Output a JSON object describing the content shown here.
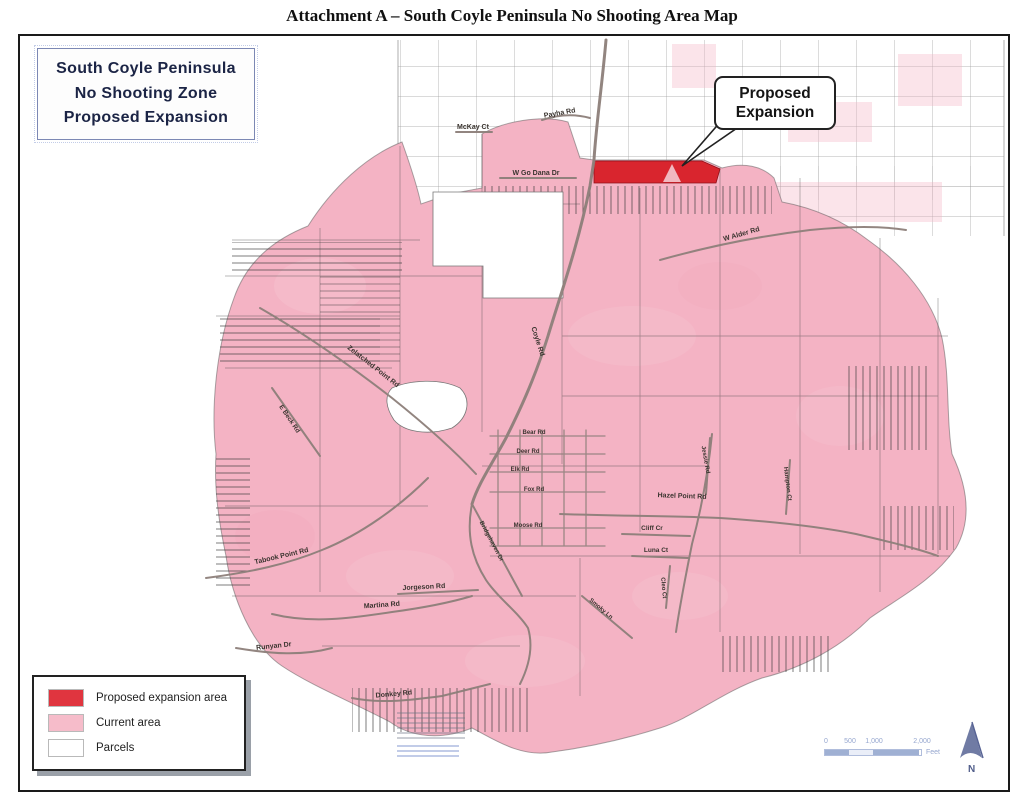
{
  "page": {
    "title": "Attachment A – South Coyle Peninsula No Shooting Area Map"
  },
  "map": {
    "inset_title": {
      "lines": [
        "South Coyle Peninsula",
        "No Shooting Zone",
        "Proposed Expansion"
      ]
    },
    "callout": {
      "lines": [
        "Proposed",
        "Expansion"
      ]
    },
    "legend": {
      "items": [
        {
          "label": "Proposed expansion area",
          "color": "#e0353f"
        },
        {
          "label": "Current area",
          "color": "#f6bcca"
        },
        {
          "label": "Parcels",
          "color": "#ffffff"
        }
      ]
    },
    "scale_bar": {
      "ticks": [
        "0",
        "500",
        "1,000",
        "2,000"
      ],
      "unit": "Feet"
    },
    "north_label": "N",
    "colors": {
      "current_area": "#f4b3c4",
      "expansion_area": "#d9252e",
      "parcel_line": "#444444",
      "road": "#8d7f7a"
    },
    "road_labels": [
      {
        "text": "McKay Ct",
        "x": 453,
        "y": 93,
        "rot": 0,
        "s": 7
      },
      {
        "text": "Payha Rd",
        "x": 540,
        "y": 79,
        "rot": -10,
        "s": 7
      },
      {
        "text": "W Go Dana Dr",
        "x": 516,
        "y": 139,
        "rot": 0,
        "s": 7
      },
      {
        "text": "W Alder Rd",
        "x": 722,
        "y": 200,
        "rot": -16,
        "s": 7
      },
      {
        "text": "Coyle Rd",
        "x": 516,
        "y": 306,
        "rot": 72,
        "s": 7
      },
      {
        "text": "Zelatched Point Rd",
        "x": 352,
        "y": 332,
        "rot": 38,
        "s": 7
      },
      {
        "text": "E Beck Rd",
        "x": 268,
        "y": 384,
        "rot": 56,
        "s": 6.5
      },
      {
        "text": "Hazel Point Rd",
        "x": 662,
        "y": 462,
        "rot": 2,
        "s": 7
      },
      {
        "text": "Jessie Rd",
        "x": 684,
        "y": 424,
        "rot": 80,
        "s": 6
      },
      {
        "text": "Hampton Ct",
        "x": 766,
        "y": 448,
        "rot": 83,
        "s": 6
      },
      {
        "text": "Bear Rd",
        "x": 514,
        "y": 398,
        "rot": 0,
        "s": 6
      },
      {
        "text": "Deer Rd",
        "x": 508,
        "y": 417,
        "rot": 0,
        "s": 6
      },
      {
        "text": "Elk Rd",
        "x": 500,
        "y": 435,
        "rot": 0,
        "s": 6
      },
      {
        "text": "Fox Rd",
        "x": 514,
        "y": 455,
        "rot": 0,
        "s": 6
      },
      {
        "text": "Moose Rd",
        "x": 508,
        "y": 491,
        "rot": 0,
        "s": 6
      },
      {
        "text": "Bridgehaven Dr",
        "x": 470,
        "y": 506,
        "rot": 62,
        "s": 6
      },
      {
        "text": "Cliff Cr",
        "x": 632,
        "y": 494,
        "rot": 0,
        "s": 6.5
      },
      {
        "text": "Luna Ct",
        "x": 636,
        "y": 516,
        "rot": 0,
        "s": 6.5
      },
      {
        "text": "Cleo Ct",
        "x": 642,
        "y": 552,
        "rot": 85,
        "s": 6
      },
      {
        "text": "Smoky Ln",
        "x": 580,
        "y": 574,
        "rot": 40,
        "s": 6
      },
      {
        "text": "Tabook Point Rd",
        "x": 262,
        "y": 522,
        "rot": -13,
        "s": 7
      },
      {
        "text": "Martina Rd",
        "x": 362,
        "y": 571,
        "rot": -4,
        "s": 7
      },
      {
        "text": "Jorgeson Rd",
        "x": 404,
        "y": 553,
        "rot": -3,
        "s": 7
      },
      {
        "text": "Runyan Dr",
        "x": 254,
        "y": 612,
        "rot": -6,
        "s": 7
      },
      {
        "text": "Donkey Rd",
        "x": 374,
        "y": 660,
        "rot": -5,
        "s": 7
      }
    ]
  }
}
